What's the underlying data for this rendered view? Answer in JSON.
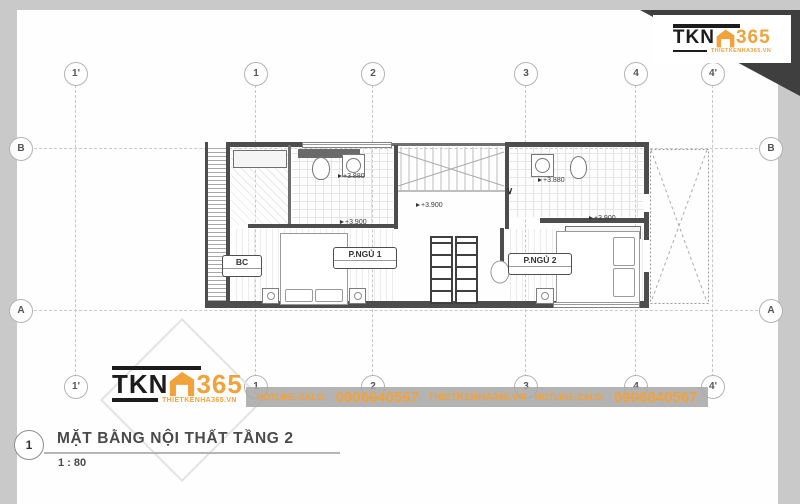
{
  "colors": {
    "accent_orange": "#F2A23B",
    "logo_black": "#1c1c1c",
    "sheet_white": "#fefefe",
    "bg_gray": "#c9c9c9"
  },
  "logo": {
    "brand": "TKN",
    "number": "365",
    "website": "THIETKENHA365.VN",
    "house_icon": "house-icon"
  },
  "grid": {
    "top": [
      "1'",
      "1",
      "2",
      "3",
      "4",
      "4'"
    ],
    "left": [
      "B",
      "A"
    ]
  },
  "plan": {
    "rooms": [
      "P.NGỦ 1",
      "P.NGỦ 2",
      "BC"
    ],
    "elevations": [
      "+3.880",
      "+3.900",
      "+3.900",
      "+3.880",
      "+3.900"
    ],
    "chevron": "∨"
  },
  "footer": {
    "hotline_label": "HOTLINE-ZALO:",
    "phone1": "0906640567",
    "website": "THIETKENHA365.VN",
    "hotline_label2": "HOTLINE-ZALO:",
    "phone2": "0906840567"
  },
  "title_block": {
    "number": "1",
    "title": "MẶT BẰNG NỘI THẤT TẦNG 2",
    "scale": "1 : 80"
  }
}
